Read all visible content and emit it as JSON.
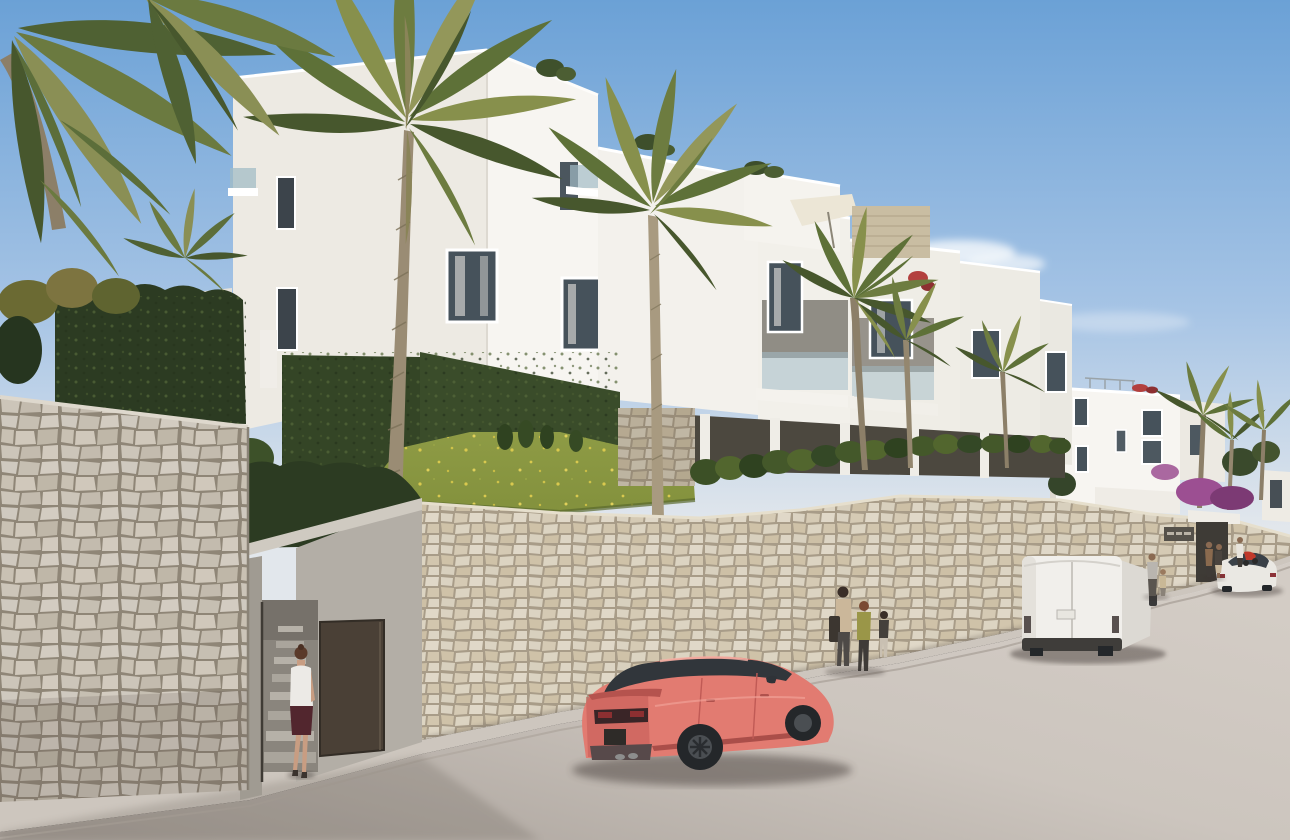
{
  "meta": {
    "kind": "architectural-exterior-render",
    "setting": "modern white hillside apartment complex seen from the street"
  },
  "palette": {
    "skyTop": "#6ba1d6",
    "skyMid": "#a6c4e5",
    "skyHorizon": "#e2e7ec",
    "cloud": "#f7fafc",
    "facadeBright": "#f7f5f1",
    "facadeShade": "#edeae3",
    "facadeDim": "#e4e0d8",
    "windowGlass": "#46525b",
    "glassRailing": "#a2bcc6",
    "fgWallJoint": "#8f8677",
    "farWallJoint": "#a89c88",
    "stoneAccent": "#c9bda2",
    "concrete": "#b3aea6",
    "concreteDark": "#a09b92",
    "doorBrown": "#4a4036",
    "grass": "#83913d",
    "grassDark": "#5a692e",
    "flowerYellow": "#d9c94e",
    "hedgeDark": "#2c3b22",
    "hedgeMid": "#44562f",
    "ivy": "#344526",
    "palmGreen": "#5e7138",
    "palmOlive": "#87904c",
    "palmDark": "#47572d",
    "trunk": "#9a8c74",
    "roadLight": "#ccc5be",
    "roadDark": "#a49c95",
    "sidewalk": "#cdc6be",
    "carCoral": "#e27b71",
    "carCoralDark": "#c35b55",
    "carGlass": "#31363b",
    "vanWhite": "#f1efeb",
    "vanShade": "#dcd9d3",
    "sedanWhite": "#eae8e3",
    "bougainvillea": "#9c4f92",
    "flowerRed": "#b3403e",
    "scooterRed": "#c0392b",
    "wheelDark": "#24272a"
  },
  "objects": {
    "buildings": [
      {
        "label": "main-apartment-block",
        "floors": 3,
        "color": "white"
      },
      {
        "label": "stepped-apartment-wing",
        "color": "white"
      },
      {
        "label": "distant-apartment-block",
        "color": "white"
      }
    ],
    "vehicles": [
      {
        "label": "sports-coupe",
        "color": "coral-pink",
        "view": "rear-three-quarter"
      },
      {
        "label": "panel-van",
        "color": "white",
        "view": "rear"
      },
      {
        "label": "sedan",
        "color": "white",
        "view": "rear"
      },
      {
        "label": "scooter",
        "color": "red"
      }
    ],
    "people": [
      {
        "label": "woman-entering-gate",
        "top": "white-blouse",
        "bottom": "dark-skirt"
      },
      {
        "label": "group-of-three-walking"
      },
      {
        "label": "man-and-child-near-van"
      },
      {
        "label": "couple-at-far-entrance"
      },
      {
        "label": "person-with-scooter"
      }
    ],
    "landscape": [
      "palm-trees",
      "grass-slope-with-yellow-wildflowers",
      "trimmed-hedges",
      "ivy-green-walls",
      "bougainvillea",
      "stone-retaining-walls"
    ],
    "street": [
      "asphalt-road",
      "sidewalk",
      "curb",
      "pedestrian-entrance-stairs",
      "entrance-gate"
    ],
    "sign": {
      "label": "development-sign-plate",
      "legible": false
    }
  }
}
